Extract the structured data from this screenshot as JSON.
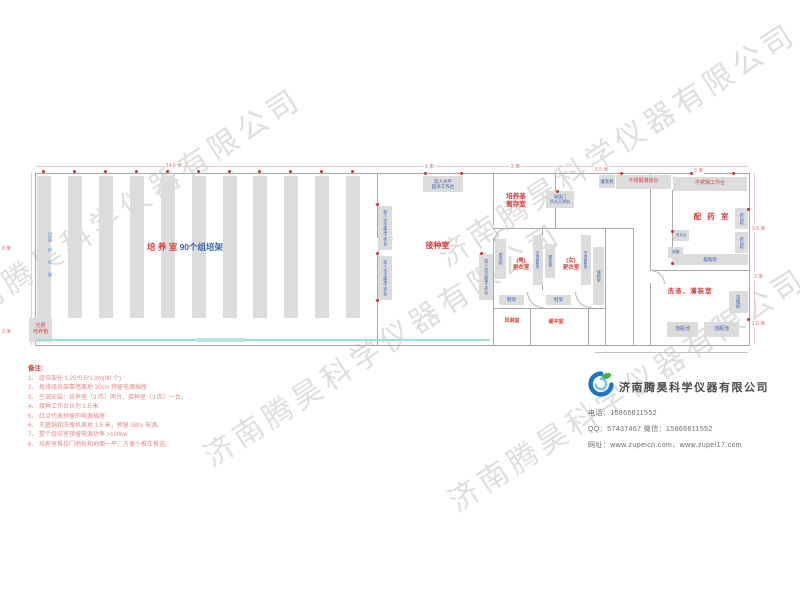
{
  "watermark": "济南腾昊科学仪器有限公司",
  "plan": {
    "dims": {
      "top_w1": "14.5 米",
      "top_w2": "5 米",
      "top_w3": "2 米",
      "top_w4": "5.5 米",
      "top_w5": "3 米",
      "left_h1": "8 米",
      "left_h2": "3 米",
      "right_h1": "3.5 米",
      "right_h2": "2 米",
      "right_h3": "1.5 米"
    },
    "culture_room": {
      "name": "培 养 室 ",
      "racks": "90个组培架",
      "aisle": "过道 0.6 米",
      "incubator_l1": "光照",
      "incubator_l2": "培养箱"
    },
    "inoculation_room": {
      "name": "接种室",
      "bench_l1": "双人水平",
      "bench_l2": "超净工作台",
      "bench_v": "双人水平超净工作台"
    },
    "medium_room": {
      "name_l1": "培养基",
      "name_l2": "暂存室",
      "door_l1": "玻璃门",
      "door_l2": "吊式天滑轨"
    },
    "prep_room": {
      "name": "配 药 室",
      "filler": "灌装机",
      "fill_table": "不锈钢灌装台",
      "work_table": "不锈钢工作台",
      "cabinet": "药品柜",
      "balance": "天平台",
      "fridge": "冰箱",
      "bottle_rack": "摆瓶架"
    },
    "wash_room": {
      "name": "洗涤、灌装室",
      "washer": "洗瓶机",
      "pool": "泡瓶池"
    },
    "dressing": {
      "wardrobe": "更衣柜",
      "bench": "不锈钢条凳",
      "shelf": "储物架",
      "male_l1": "(男)",
      "male_l2": "更衣室",
      "female_l1": "(女)",
      "female_l2": "更衣室",
      "shoe_rack": "鞋架",
      "air_shower": "风淋室",
      "buffer": "缓冲室"
    }
  },
  "notes": {
    "title": "备注:",
    "item1": "1、 组培架长 1.25*0.5*1.8m(90 个)",
    "item2": "2、 每排组培架靠墙离地 30cm 预留电源插座",
    "item3": "3、 空调安装：培养室（3 匹）两台，接种室（3 匹）一台。",
    "item4": "4、 接种工作台长为 1.5 米",
    "item5": "5、 红点代表预留的电源插座",
    "item6": "6、 灭菌锅和洗瓶机离地 1.5 米，预留 380v 电源。",
    "item7": "7、 整个组培室预留电源功率 >100kw",
    "item8": "8、 培养室推拉门地轨和地面一平，方便小推车推送。"
  },
  "company": {
    "name": "济南腾昊科学仪器有限公司",
    "phone_label": "电话：",
    "phone": "15866611552",
    "qq_label": "QQ：",
    "qq": "57437467",
    "wechat_label": "  微信：",
    "wechat": "15866611552",
    "site_label": "网址：",
    "sites": "www.zupeicn.com、www.zupei17.com"
  }
}
